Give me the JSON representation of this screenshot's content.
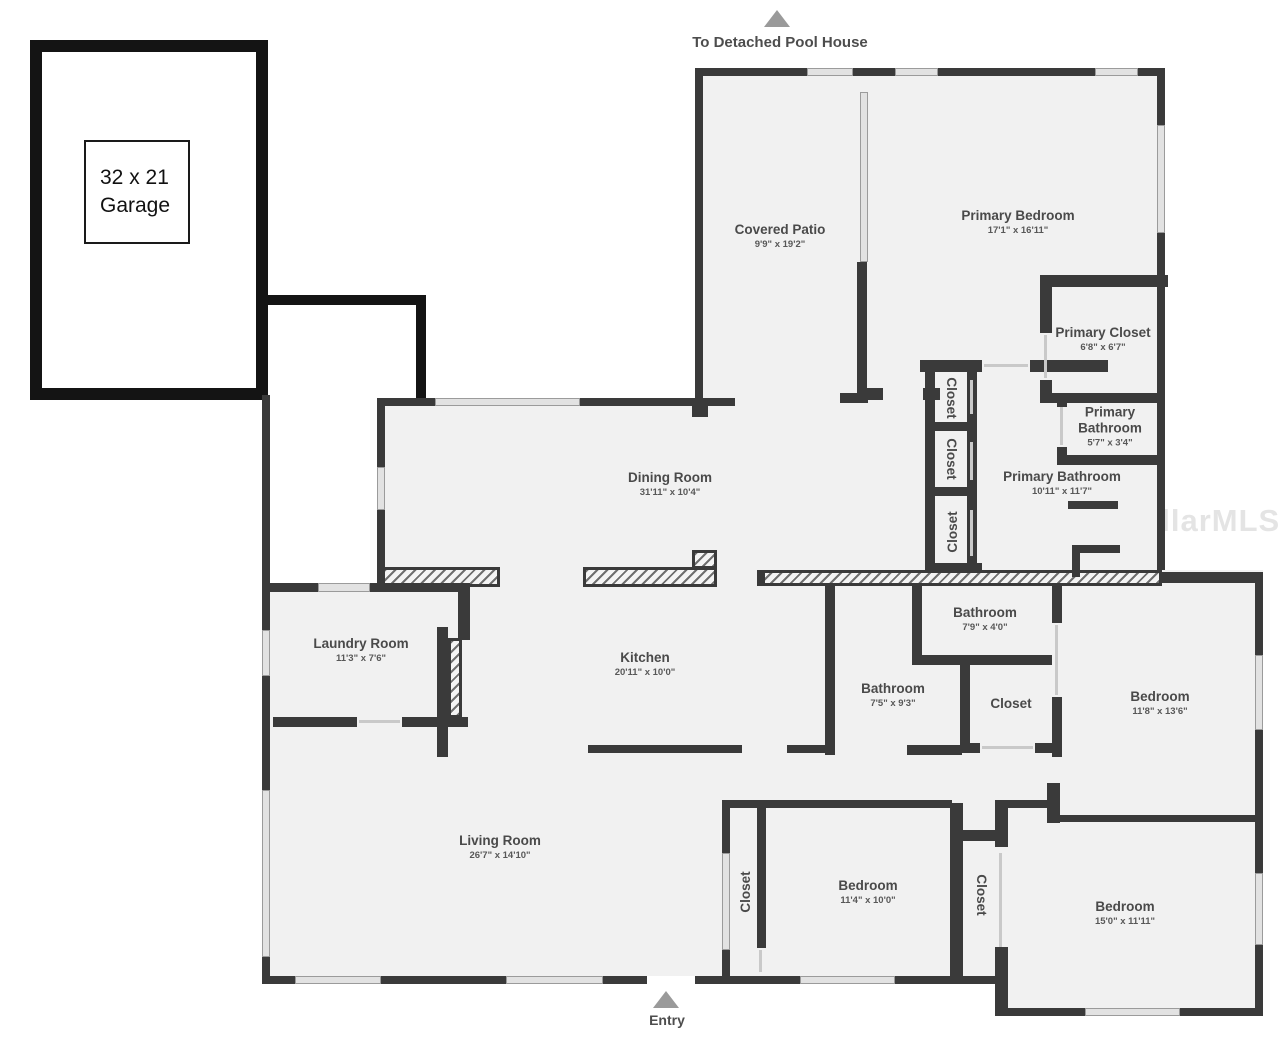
{
  "title": "Residential floor plan",
  "garage": {
    "size": "32 x 21",
    "label": "Garage"
  },
  "annotations": {
    "pool_house": "To Detached Pool House",
    "entry": "Entry"
  },
  "watermark": "StellarMLS",
  "colors": {
    "wall": "#3a3a3a",
    "garage_wall": "#141414",
    "room_fill": "#f1f1f1",
    "label_text": "#4a4a4a",
    "arrow": "#9a9a9a"
  },
  "rooms": [
    {
      "id": "covered-patio",
      "name": "Covered Patio",
      "dims": "9'9\" x 19'2\""
    },
    {
      "id": "primary-bedroom",
      "name": "Primary Bedroom",
      "dims": "17'1\" x 16'11\""
    },
    {
      "id": "primary-closet",
      "name": "Primary Closet",
      "dims": "6'8\" x 6'7\""
    },
    {
      "id": "primary-bathroom-small",
      "name": "Primary Bathroom",
      "dims": "5'7\" x 3'4\""
    },
    {
      "id": "primary-bathroom",
      "name": "Primary Bathroom",
      "dims": "10'11\" x 11'7\""
    },
    {
      "id": "dining-room",
      "name": "Dining Room",
      "dims": "31'11\" x 10'4\""
    },
    {
      "id": "kitchen",
      "name": "Kitchen",
      "dims": "20'11\" x 10'0\""
    },
    {
      "id": "laundry-room",
      "name": "Laundry Room",
      "dims": "11'3\" x 7'6\""
    },
    {
      "id": "living-room",
      "name": "Living Room",
      "dims": "26'7\" x 14'10\""
    },
    {
      "id": "bathroom-top",
      "name": "Bathroom",
      "dims": "7'9\" x 4'0\""
    },
    {
      "id": "bathroom-mid",
      "name": "Bathroom",
      "dims": "7'5\" x 9'3\""
    },
    {
      "id": "closet-hall",
      "name": "Closet",
      "dims": ""
    },
    {
      "id": "bedroom-right",
      "name": "Bedroom",
      "dims": "11'8\" x 13'6\""
    },
    {
      "id": "bedroom-middle",
      "name": "Bedroom",
      "dims": "11'4\" x 10'0\""
    },
    {
      "id": "bedroom-bottom",
      "name": "Bedroom",
      "dims": "15'0\" x 11'11\""
    },
    {
      "id": "closet-col-1",
      "name": "Closet",
      "dims": ""
    },
    {
      "id": "closet-col-2",
      "name": "Closet",
      "dims": ""
    },
    {
      "id": "closet-col-3",
      "name": "Closet",
      "dims": ""
    },
    {
      "id": "closet-bed-middle",
      "name": "Closet",
      "dims": ""
    },
    {
      "id": "closet-bed-bottom",
      "name": "Closet",
      "dims": ""
    }
  ]
}
